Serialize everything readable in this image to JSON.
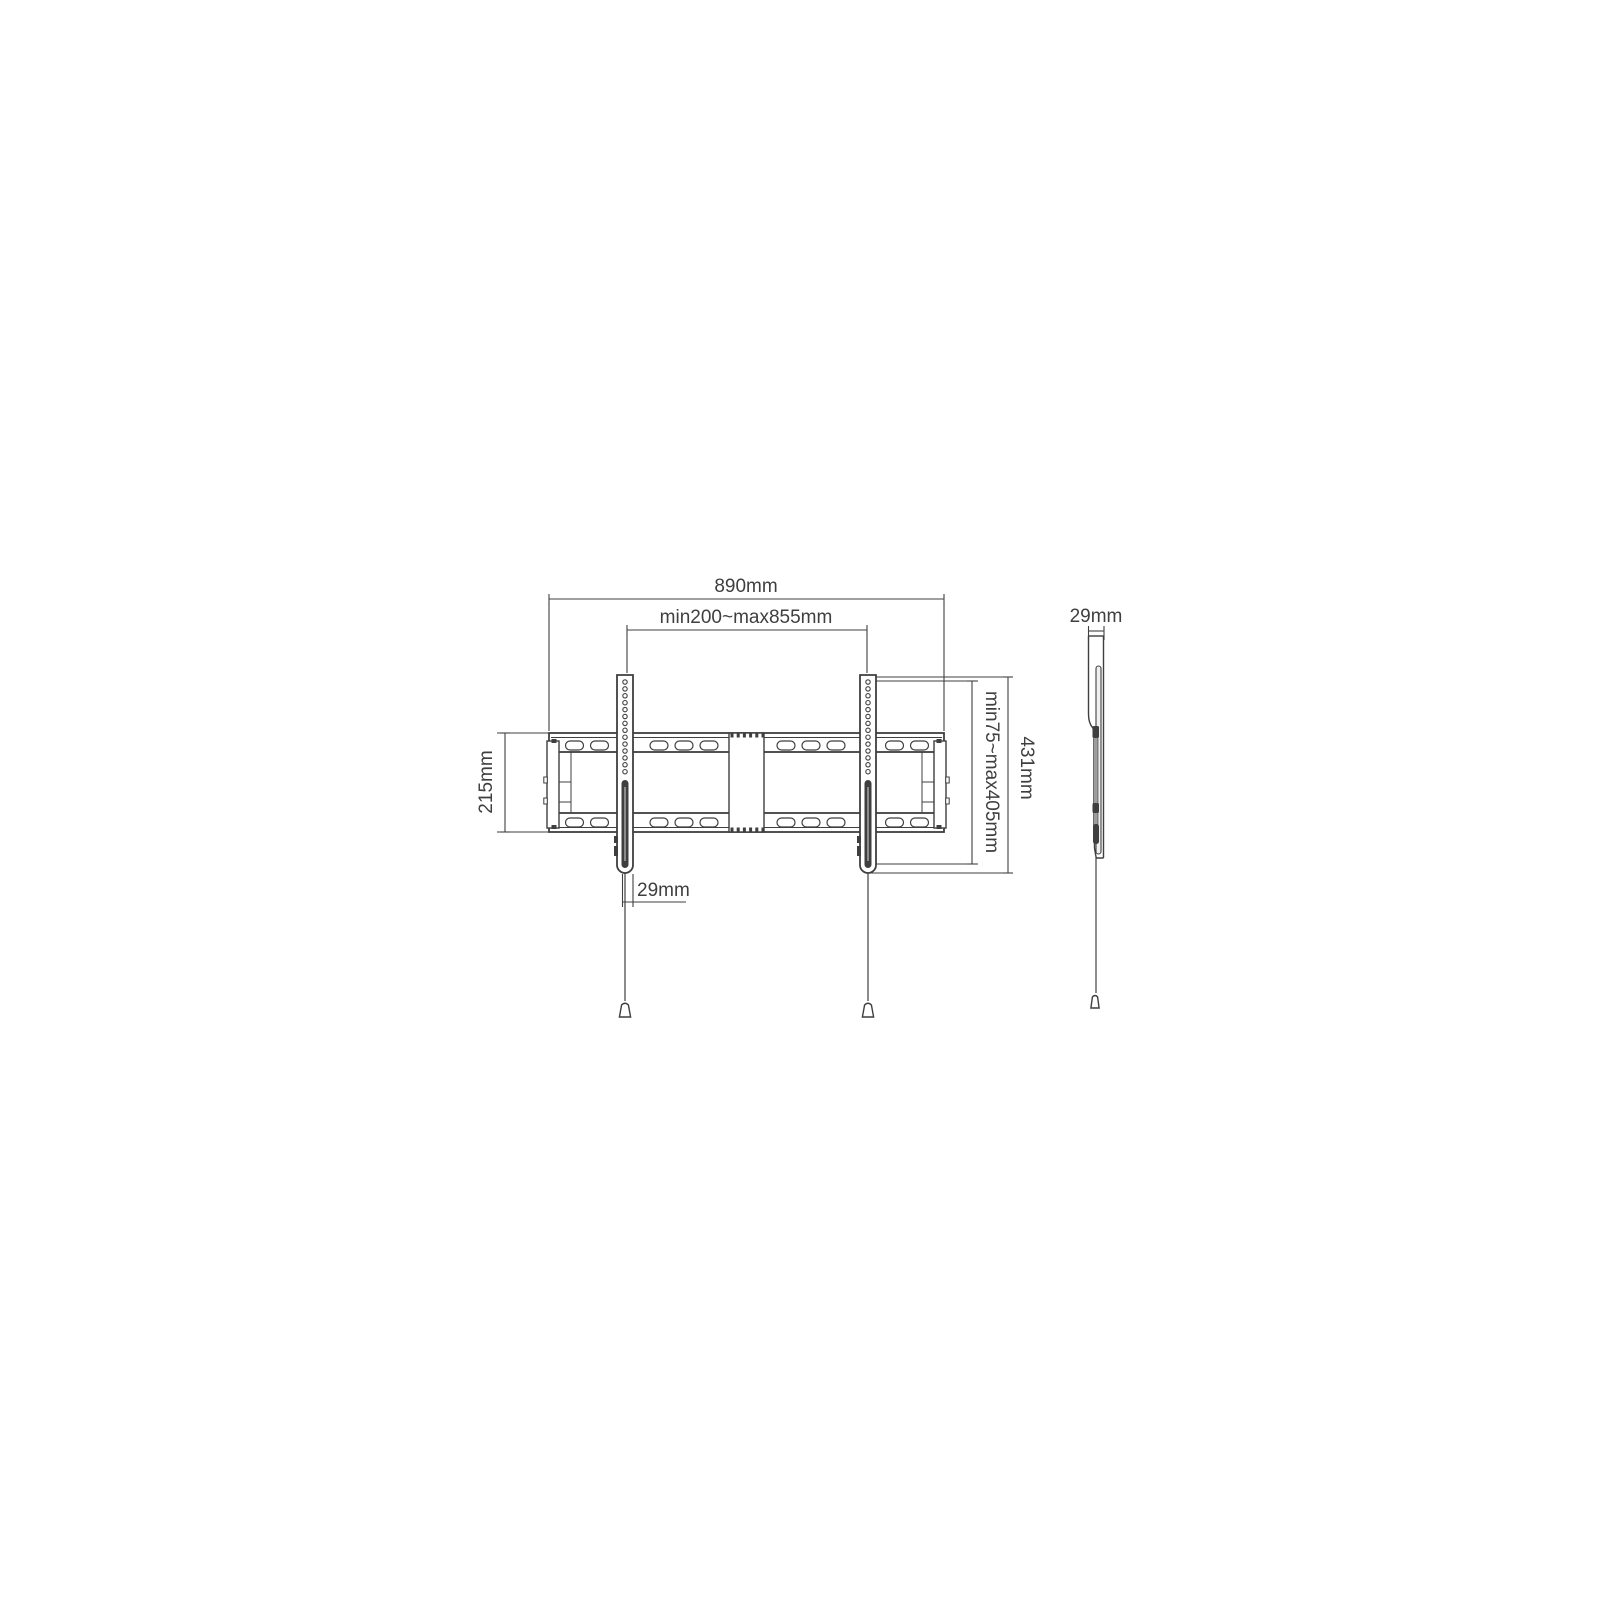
{
  "drawing": {
    "front_view": {
      "dim_overall_width": "890mm",
      "dim_mount_width_range": "min200~max855mm",
      "dim_rail_height": "215mm",
      "dim_mount_height_range": "min75~max405mm",
      "dim_bracket_height": "431mm",
      "dim_bracket_width": "29mm"
    },
    "side_view": {
      "dim_depth": "29mm"
    },
    "colors": {
      "line": "#3f3f3f",
      "background": "#ffffff"
    }
  }
}
